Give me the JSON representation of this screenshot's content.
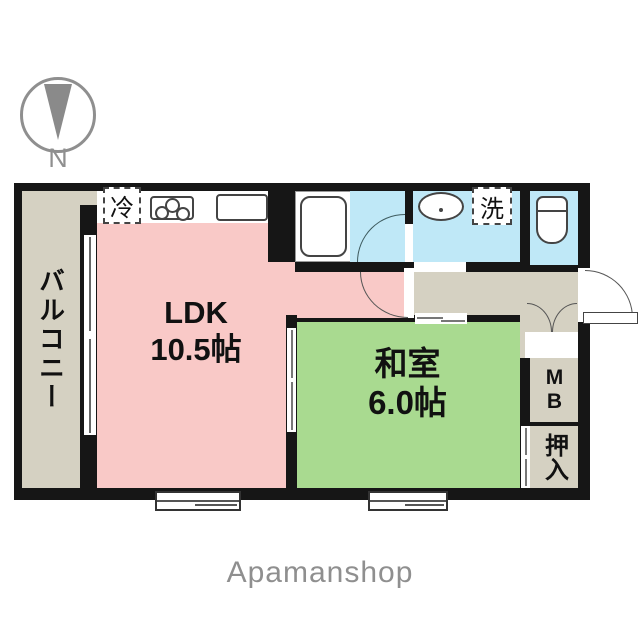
{
  "compass": {
    "label": "N"
  },
  "logo": {
    "text": "Apamanshop"
  },
  "rooms": {
    "balcony": {
      "label": "バルコニー"
    },
    "ldk": {
      "name": "LDK",
      "size": "10.5帖"
    },
    "washitsu": {
      "name": "和室",
      "size": "6.0帖"
    }
  },
  "labels": {
    "refrigerator": "冷",
    "laundry": "洗",
    "meter_box": "MB",
    "oshiire": "押入"
  },
  "colors": {
    "ldk_pink": "#f9c9c7",
    "washitsu_green": "#a9da90",
    "wet_area_blue": "#bfe8f7",
    "balcony_beige": "#d5d1c2",
    "wall_black": "#161616",
    "logo_gray": "#8f8f8f"
  }
}
